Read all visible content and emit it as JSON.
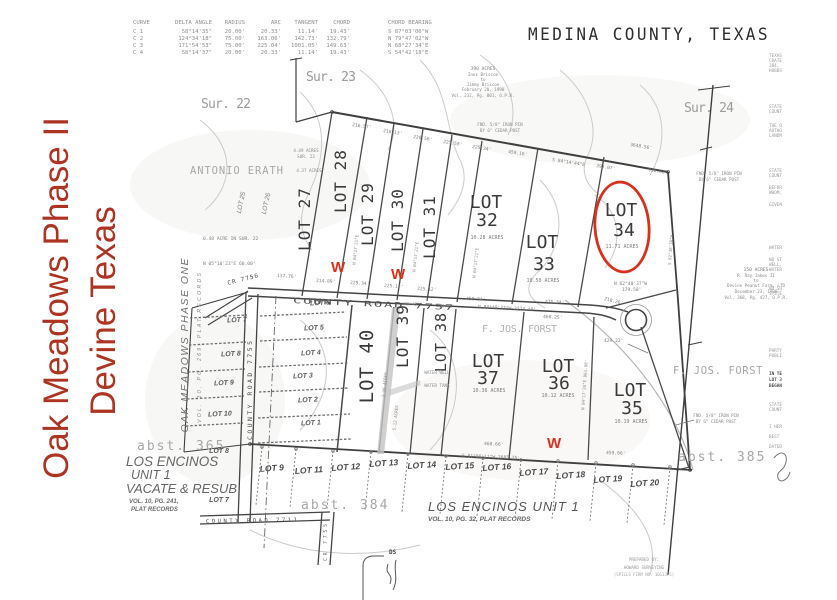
{
  "annotations": {
    "title_line1": "Oak Meadows Phase II",
    "title_line2": "Devine Texas",
    "title_color": "#ad3322",
    "highlight_color": "#d9301c",
    "w_marks": [
      "W",
      "W",
      "W"
    ],
    "circled_lot": "LOT 34"
  },
  "county_header": "MEDINA COUNTY, TEXAS",
  "curve_table": {
    "headers": [
      "CURVE",
      "DELTA ANGLE",
      "RADIUS",
      "ARC",
      "TANGENT",
      "CHORD",
      "CHORD BEARING"
    ],
    "rows": [
      [
        "C 1",
        "58°14'35\"",
        "20.00'",
        "20.33'",
        "11.14'",
        "19.43'",
        "S 87°03'06\"W"
      ],
      [
        "C 2",
        "124°34'18\"",
        "75.00'",
        "163.06'",
        "142.73'",
        "132.79'",
        "N 79°47'02\"W"
      ],
      [
        "C 3",
        "171°54'53\"",
        "75.00'",
        "225.04'",
        "1001.05'",
        "149.63'",
        "N 68°27'34\"E"
      ],
      [
        "C 4",
        "58°14'37\"",
        "20.00'",
        "20.33'",
        "11.14'",
        "19.43'",
        "S 54°42'18\"E"
      ]
    ]
  },
  "surveys": {
    "sur22": "Sur. 22",
    "sur23": "Sur. 23",
    "sur24": "Sur. 24"
  },
  "abstracts": {
    "a365": "abst. 365",
    "a384": "abst. 384",
    "a385": "abst. 385"
  },
  "landowners": {
    "erath": "ANTONIO ERATH",
    "forst_center": "F. JOS. FORST",
    "forst_east": "F. JOS. FORST"
  },
  "phase2": {
    "rotated_lots": [
      "LOT 27",
      "LOT 28",
      "LOT 29",
      "LOT 30",
      "LOT 31"
    ],
    "lot32": {
      "l1": "LOT",
      "l2": "32",
      "acres": "10.28 ACRES"
    },
    "lot33": {
      "l1": "LOT",
      "l2": "33",
      "acres": "10.50 ACRES"
    },
    "lot34": {
      "l1": "LOT",
      "l2": "34",
      "acres": "11.71 ACRES"
    },
    "lot35": {
      "l1": "LOT",
      "l2": "35",
      "acres": "10.19 ACRES"
    },
    "lot36": {
      "l1": "LOT",
      "l2": "36",
      "acres": "10.12 ACRES"
    },
    "lot37": {
      "l1": "LOT",
      "l2": "37",
      "acres": "10.36 ACRES"
    },
    "lot38": "LOT 38",
    "lot39": "LOT 39",
    "lot40": {
      "label": "LOT 40",
      "acres": "3.26 ACRES"
    },
    "acres39": "5.12 ACRES",
    "lot27_note1": "4.49 ACRES",
    "lot27_note2": "SUR. 23",
    "lot27_note3": "4.37 ACRES",
    "sur22_note": "0.48 ACRE IN SUR. 22",
    "water_well": "WATER WELL",
    "water_tank": "WATER TANK"
  },
  "phase_one": {
    "title": "OAK MEADOWS PHASE ONE",
    "subtitle": "VOL. 10, PG. 269, PLAT RECORDS",
    "west_lots": [
      "LOT 7",
      "LOT 8",
      "LOT 9",
      "LOT 10"
    ],
    "mid_lots": [
      "LOT 6",
      "LOT 5",
      "LOT 4",
      "LOT 3",
      "LOT 2",
      "LOT 1"
    ],
    "small_lots": [
      "LOT 25",
      "LOT 26"
    ]
  },
  "los_encinos_resub": {
    "line1": "LOS ENCINOS",
    "line2": "UNIT 1",
    "line3": "VACATE & RESUB",
    "line4": "VOL. 10, PG. 241,",
    "line5": "PLAT RECORDS",
    "lot8": "LOT 8",
    "lot7": "LOT 7"
  },
  "los_encinos_unit1": {
    "title": "LOS ENCINOS UNIT 1",
    "subtitle": "VOL. 10, PG. 32, PLAT RECORDS",
    "bottom_lots": [
      "LOT 9",
      "LOT 11",
      "LOT 12",
      "LOT 13",
      "LOT 14",
      "LOT 15",
      "LOT 16",
      "LOT 17",
      "LOT 18",
      "LOT 19",
      "LOT 20"
    ]
  },
  "roads": {
    "cr7757": "COUNTY ROAD 7757",
    "cr7756": "CR 7756",
    "cr7755": "COUNTY ROAD 7755",
    "cr7755_stub": "CR 7755",
    "cr7711": "COUNTY ROAD 7711"
  },
  "deeds": {
    "briscoe": [
      "390 ACRES",
      "Inez Briscoe",
      "to",
      "Jimmy Briscoe",
      "February 20, 1990",
      "Vol. 232, Pg. 801, O.P.R."
    ],
    "jakes": [
      "150 ACRES",
      "R. Ray Jakes II",
      "to",
      "Devine Peanut Farm, LTD",
      "December 23, 1998",
      "Vol. 368, Pg. 427, O.P.R."
    ]
  },
  "monuments": {
    "pin_line1": "FND. 5/8\" IRON PIN",
    "pin_line2": "BY 6\" CEDAR POST"
  },
  "bearings": {
    "top_dims": [
      "216.57'",
      "218.13'",
      "220.56'",
      "225.58'",
      "225.34'",
      "459.16'"
    ],
    "top_bearing": "S 84°14'44\"E",
    "top_total": "3648.56'",
    "d930": "930.82'",
    "d393": "393.07'",
    "road_dims": [
      "137.76'",
      "214.89'",
      "229.34'",
      "225.12'",
      "225.12'"
    ],
    "d928": "928.16",
    "n0510": "N 05°10'23\"E  60.00'",
    "mid_bearing": "N 83°49'37\"W  2273.40'",
    "d458": "458.34'",
    "d475": "475.34'",
    "d460": "460.25'",
    "d218": "218.26'",
    "lot34_s1": "N 62°40'37\"W",
    "lot34_s2": "179.50'",
    "d429": "429.22'",
    "south_bearing": "S 81°56'11\"W  2085.25'",
    "d46066": "460.66'",
    "d459": "459.06'",
    "lotline_bearing": "N 04°17'21\"E",
    "east_bearing": "S 02°38'30\"W",
    "lower_bearing": "N 04°17'20\"E  861.08'",
    "lot40_dims": [
      "229.94'",
      "225.43'",
      "235.13'"
    ]
  },
  "prepared_by": {
    "line1": "PREPARED BY:",
    "line2": "HOWARD SURVEYING",
    "line3": "(SPILLS FIRM NO. 1011375)"
  },
  "detail": {
    "ds": "DS"
  },
  "margin_fragments": [
    "TEXAS",
    "CRATE",
    "384,",
    "HOBBS",
    "STATE",
    "COUNT",
    "THE O",
    "AUTHO",
    "LANDM",
    "STATE",
    "COUNT",
    "BEFOR",
    "WHOM,",
    "GIVEN",
    "WATER",
    "NO ST",
    "WELL,",
    "WATER",
    "NO SU",
    "SYSTE",
    "PARTY",
    "PUBLI",
    "IN TE",
    "LOT 3",
    "BEGAN",
    "STATE",
    "COUNT",
    "I HER",
    "BEST",
    "DATED"
  ]
}
